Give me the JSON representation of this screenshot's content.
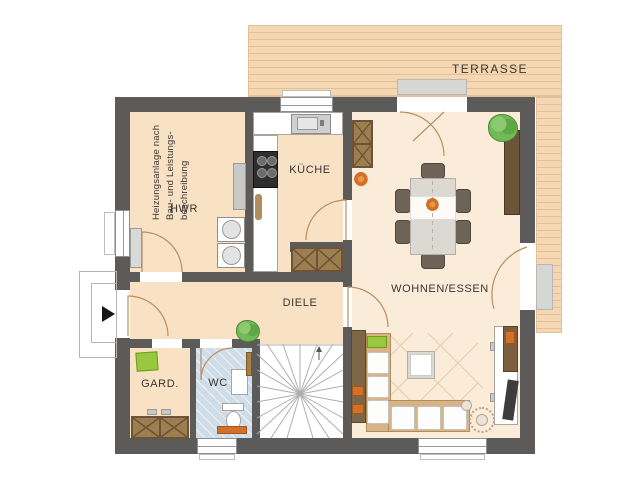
{
  "plan": {
    "terrace": {
      "label": "TERRASSE"
    },
    "rooms": {
      "hwr": {
        "label": "HWR",
        "note": [
          "Heizungsanlage nach",
          "Bau- und Leistungs-",
          "beschreibung"
        ]
      },
      "kueche": {
        "label": "KÜCHE"
      },
      "diele": {
        "label": "DIELE"
      },
      "wohnen_essen": {
        "label": "WOHNEN/ESSEN"
      },
      "gard": {
        "label": "GARD."
      },
      "wc": {
        "label": "WC"
      }
    },
    "symbols": [
      "entrance-arrow",
      "staircase",
      "washing-machine",
      "dryer",
      "heater",
      "kitchen-sink",
      "cooktop",
      "dining-table",
      "dining-chair",
      "sofa",
      "coffee-table",
      "rug",
      "floor-lamp",
      "tv-sideboard",
      "sideboard",
      "wardrobe",
      "toilet",
      "washbasin",
      "plant",
      "window",
      "door-swing"
    ]
  },
  "colors": {
    "wall": "#5c5b59",
    "floor": "#f9e2c4",
    "living_floor": "#faecd9",
    "terrace": "#f6d7b3",
    "terrace_line": "#e3bf9a",
    "wc_floor": "#cfdde8",
    "wood_dark": "#6b5437",
    "wood_mid": "#9c7e4f",
    "sofa": "#d6b488",
    "chair": "#6e6357",
    "plant_green": "#72b959",
    "accent_green": "#97c83d",
    "accent_orange": "#d2722a",
    "door_arc": "#b98e60",
    "text": "#3a3632"
  }
}
